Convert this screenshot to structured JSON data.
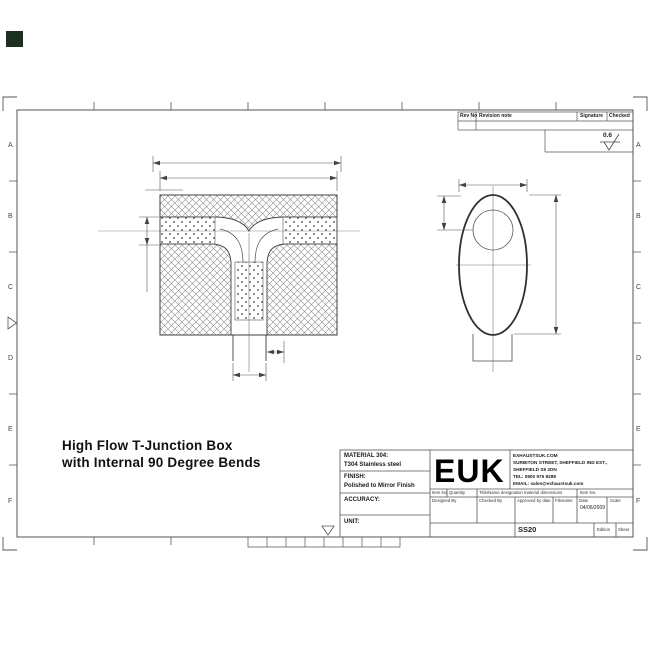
{
  "page": {
    "marker_color": "#1c2f22"
  },
  "frame": {
    "row_labels": [
      "A",
      "B",
      "C",
      "D",
      "E",
      "F"
    ]
  },
  "revision_table": {
    "headers": [
      "Rev No",
      "Revision note",
      "Signature",
      "Checked"
    ],
    "surface_finish_value": "0.6"
  },
  "drawing_title": {
    "line1": "High Flow T-Junction Box",
    "line2": "with Internal 90 Degree Bends"
  },
  "title_block": {
    "material_label": "MATERIAL 304:",
    "material_value": "T304 Stainless steel",
    "finish_label": "FINISH:",
    "finish_value": "Polished to Mirror Finish",
    "accuracy_label": "ACCURACY:",
    "unit_label": "UNIT:",
    "logo": "EUK",
    "company": {
      "line1": "EXHAUSTSUK.COM",
      "line2": "SURBITON STREET, SHEFFIELD IND EST.,",
      "line3": "SHEFFIELD S9 2DN",
      "line4": "TEL: 0800 975 9288",
      "line5": "EMAIL: sales@exhaustsuk.com"
    },
    "item_row": {
      "item_no": "Item No",
      "quantity": "Quantity",
      "title_name": "Title/Name designation material dimensions",
      "item_no2": "Item No."
    },
    "sign_row": {
      "designed": "Designed By",
      "checked": "Checked By",
      "approved": "Approved by date",
      "filename": "Filename",
      "date": "Date",
      "scale": "Scale"
    },
    "date_value": "04/06/2009",
    "drawing_number": "SS20",
    "edition_label": "Edition",
    "sheet_label": "Sheet"
  }
}
